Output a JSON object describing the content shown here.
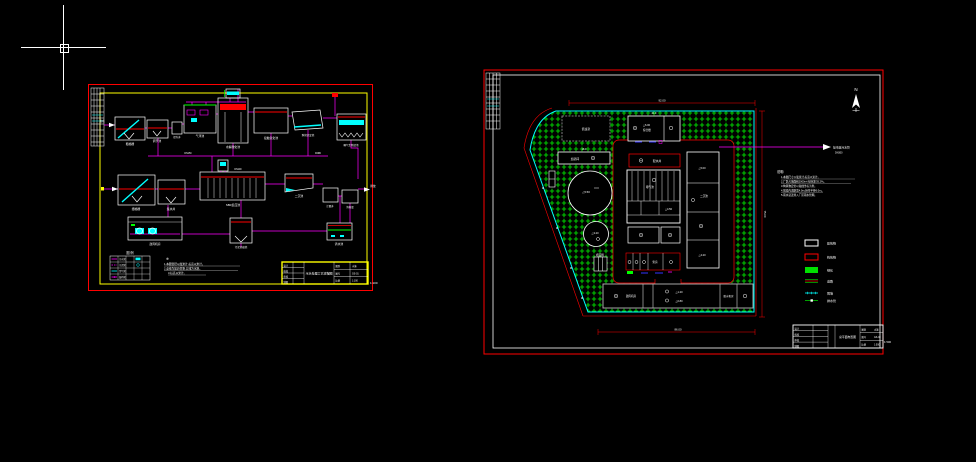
{
  "colors": {
    "background": "#000000",
    "border_outer": "#ff0000",
    "border_inner_left": "#ffff00",
    "border_inner_right": "#ffffff",
    "pipe": "#ff00ff",
    "water_level": "#ff0000",
    "equipment": "#00ffff",
    "greenery": "#00c800",
    "fence": "#00ffff",
    "dim_text": "#ff2a2a",
    "drawing_line": "#ffffff",
    "building_dashed": "#9a9a9a"
  },
  "cursor": {
    "type": "crosshair"
  },
  "shared_tb": {
    "design": "设计",
    "check": "校核",
    "review": "审核",
    "draft": "制图",
    "type_label": "图别",
    "no_label": "图号",
    "scale_label": "比例",
    "type_value": "水施"
  },
  "left": {
    "flow_in": "进水",
    "flow_out": "排放",
    "tank_labels": [
      "粗格栅",
      "调节池",
      "提升井",
      "气浮池",
      "水解酸化池",
      "接触氧化池",
      "斜管沉淀池",
      "曝气生物滤池",
      "细格栅",
      "集水井",
      "SBR反应池",
      "二沉池",
      "计量井",
      "消毒渠",
      "鼓风机房",
      "污泥浓缩池",
      "清水池"
    ],
    "pipe_labels": [
      "DN150",
      "DN100",
      "DN80"
    ],
    "legend": {
      "title": "图 例",
      "rows": [
        "污水管",
        "污泥管",
        "空气管",
        "加药管"
      ]
    },
    "notes": {
      "symbol": "※",
      "lines": [
        "1.本图管径以毫米计,标高以米计。",
        "2.虚线为加药管路,实线为水路。",
        "3.标高以米计。"
      ]
    },
    "titleblock": {
      "title": "污水处理工艺流程图",
      "no": "GS-01",
      "scale": "1:100",
      "edge": "1:100"
    }
  },
  "right": {
    "north": "N",
    "outfall": {
      "label": "接市政污水管",
      "dn": "DN300"
    },
    "labels": {
      "guard": "值班室",
      "office_elev": "△6.00",
      "office": "综合楼",
      "dosing": "加药间",
      "distributor": "配水井",
      "clar1": "△5.50",
      "clar2": "△3.20",
      "drybed": "晒泥场",
      "aer1": "△4.50",
      "aer2": "曝气池",
      "rc1": "△5.00",
      "rc2": "二沉池",
      "rc3": "△4.20",
      "pump": "泵房",
      "b1": "鼓风机房",
      "bm1": "△1.20",
      "bm2": "△0.80",
      "b3": "脱水机房"
    },
    "dims": {
      "top": "92.00",
      "bottom": "86.00",
      "right": "75.00",
      "d1": "21.0",
      "d2": "18.0",
      "d3": "13.0",
      "d4": "30.0"
    },
    "notes": {
      "title": "说明:",
      "lines": [
        "1.本图尺寸以毫米计,标高以米计。",
        "2.厂区占地面积2000m²,绿化率35.2%。",
        "3.构筑物定位以轴线坐标为准。",
        "4.围墙内道路宽4.0m,转弯半径6.0m。",
        "5.雨水就近排入厂区雨水管网。"
      ]
    },
    "legend": [
      {
        "label": "建筑物"
      },
      {
        "label": "构筑物"
      },
      {
        "label": "绿化"
      },
      {
        "label": "道路"
      },
      {
        "label": "围墙"
      },
      {
        "label": "排水管"
      }
    ],
    "titleblock": {
      "title": "总平面布置图",
      "no": "GS-02",
      "scale": "1:500",
      "edge": "1:500"
    }
  }
}
